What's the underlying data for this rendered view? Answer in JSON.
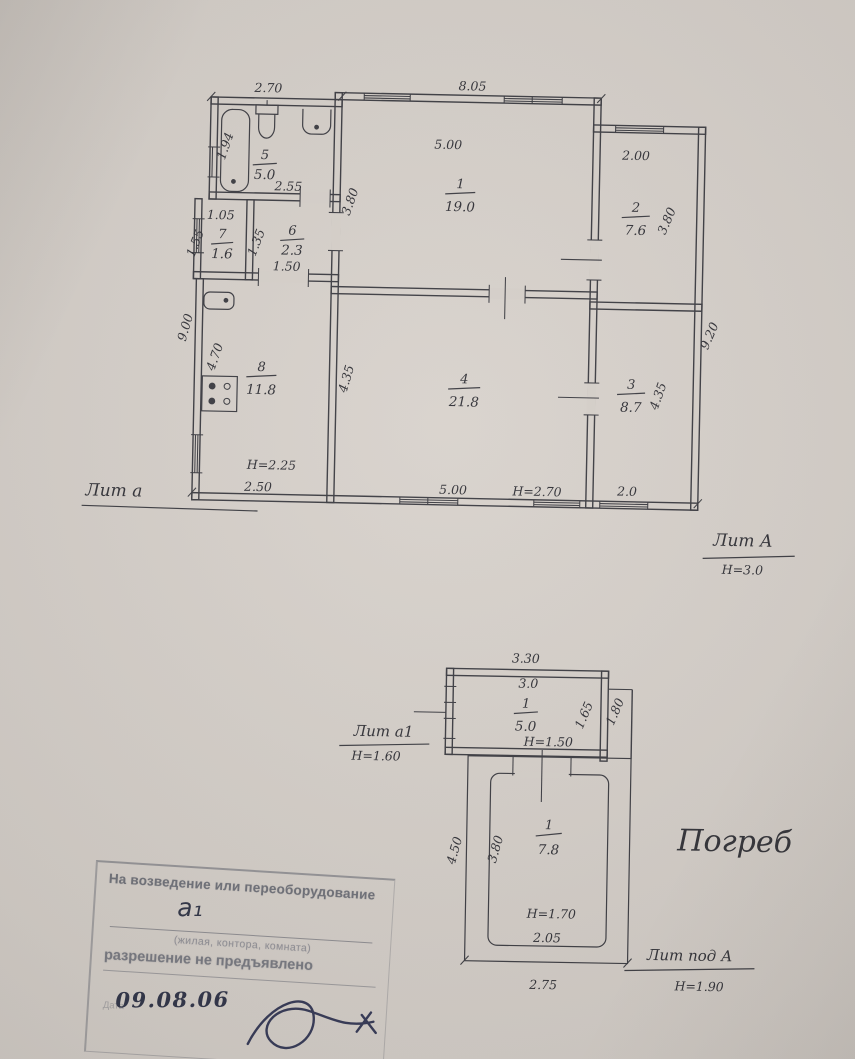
{
  "colors": {
    "paper": "#d3cdc7",
    "ink": "#3b3b41",
    "pen": "#2f3347",
    "stamp": "#73757e"
  },
  "main_plan": {
    "litera_left": "Лит а",
    "litera_right": "Лит А",
    "litera_right_height": "Н=3.0",
    "rooms": {
      "r1": {
        "number": "1",
        "area": "19.0"
      },
      "r2": {
        "number": "2",
        "area": "7.6"
      },
      "r3": {
        "number": "3",
        "area": "8.7"
      },
      "r4": {
        "number": "4",
        "area": "21.8"
      },
      "r5": {
        "number": "5",
        "area": "5.0"
      },
      "r6": {
        "number": "6",
        "area": "2.3"
      },
      "r7": {
        "number": "7",
        "area": "1.6"
      },
      "r8": {
        "number": "8",
        "area": "11.8"
      }
    },
    "dims": {
      "wing_top": "2.70",
      "main_top": "8.05",
      "r1_w": "5.00",
      "r1_d": "3.80",
      "r2_w": "2.00",
      "r2_d": "3.80",
      "right_outer": "9.20",
      "left_outer": "9.00",
      "r5_d": "1.94",
      "r5_w": "2.55",
      "r7_w": "1.05",
      "r7_d": "1.55",
      "r6_d": "1.35",
      "r6_door": "1.50",
      "r8_d": "4.70",
      "r8_h": "Н=2.25",
      "r8_w": "2.50",
      "r4_d": "4.35",
      "r4_w": "5.00",
      "r4_h": "Н=2.70",
      "r3_d": "4.35",
      "r3_w": "2.0"
    }
  },
  "cellar_plan": {
    "litera_left": "Лит а1",
    "litera_left_height": "Н=1.60",
    "litera_under": "Лит под А",
    "litera_under_height": "Н=1.90",
    "title": "Погреб",
    "entry": {
      "number": "1",
      "area": "5.0"
    },
    "cellar": {
      "number": "1",
      "area": "7.8"
    },
    "dims": {
      "top_outer": "3.30",
      "top_inner": "3.0",
      "right_inner": "1.65",
      "right_outer": "1.80",
      "entry_h": "Н=1.50",
      "left_outer": "4.50",
      "left_inner": "3.80",
      "cellar_h": "Н=1.70",
      "inner_w": "2.05",
      "outer_w": "2.75"
    }
  },
  "stamp": {
    "line1": "На возведение или переоборудование",
    "written": "а₁",
    "caption": "(жилая, контора, комната)",
    "line2": "разрешение не предъявлено",
    "date_label": "Дата",
    "date": "09.08.06"
  }
}
